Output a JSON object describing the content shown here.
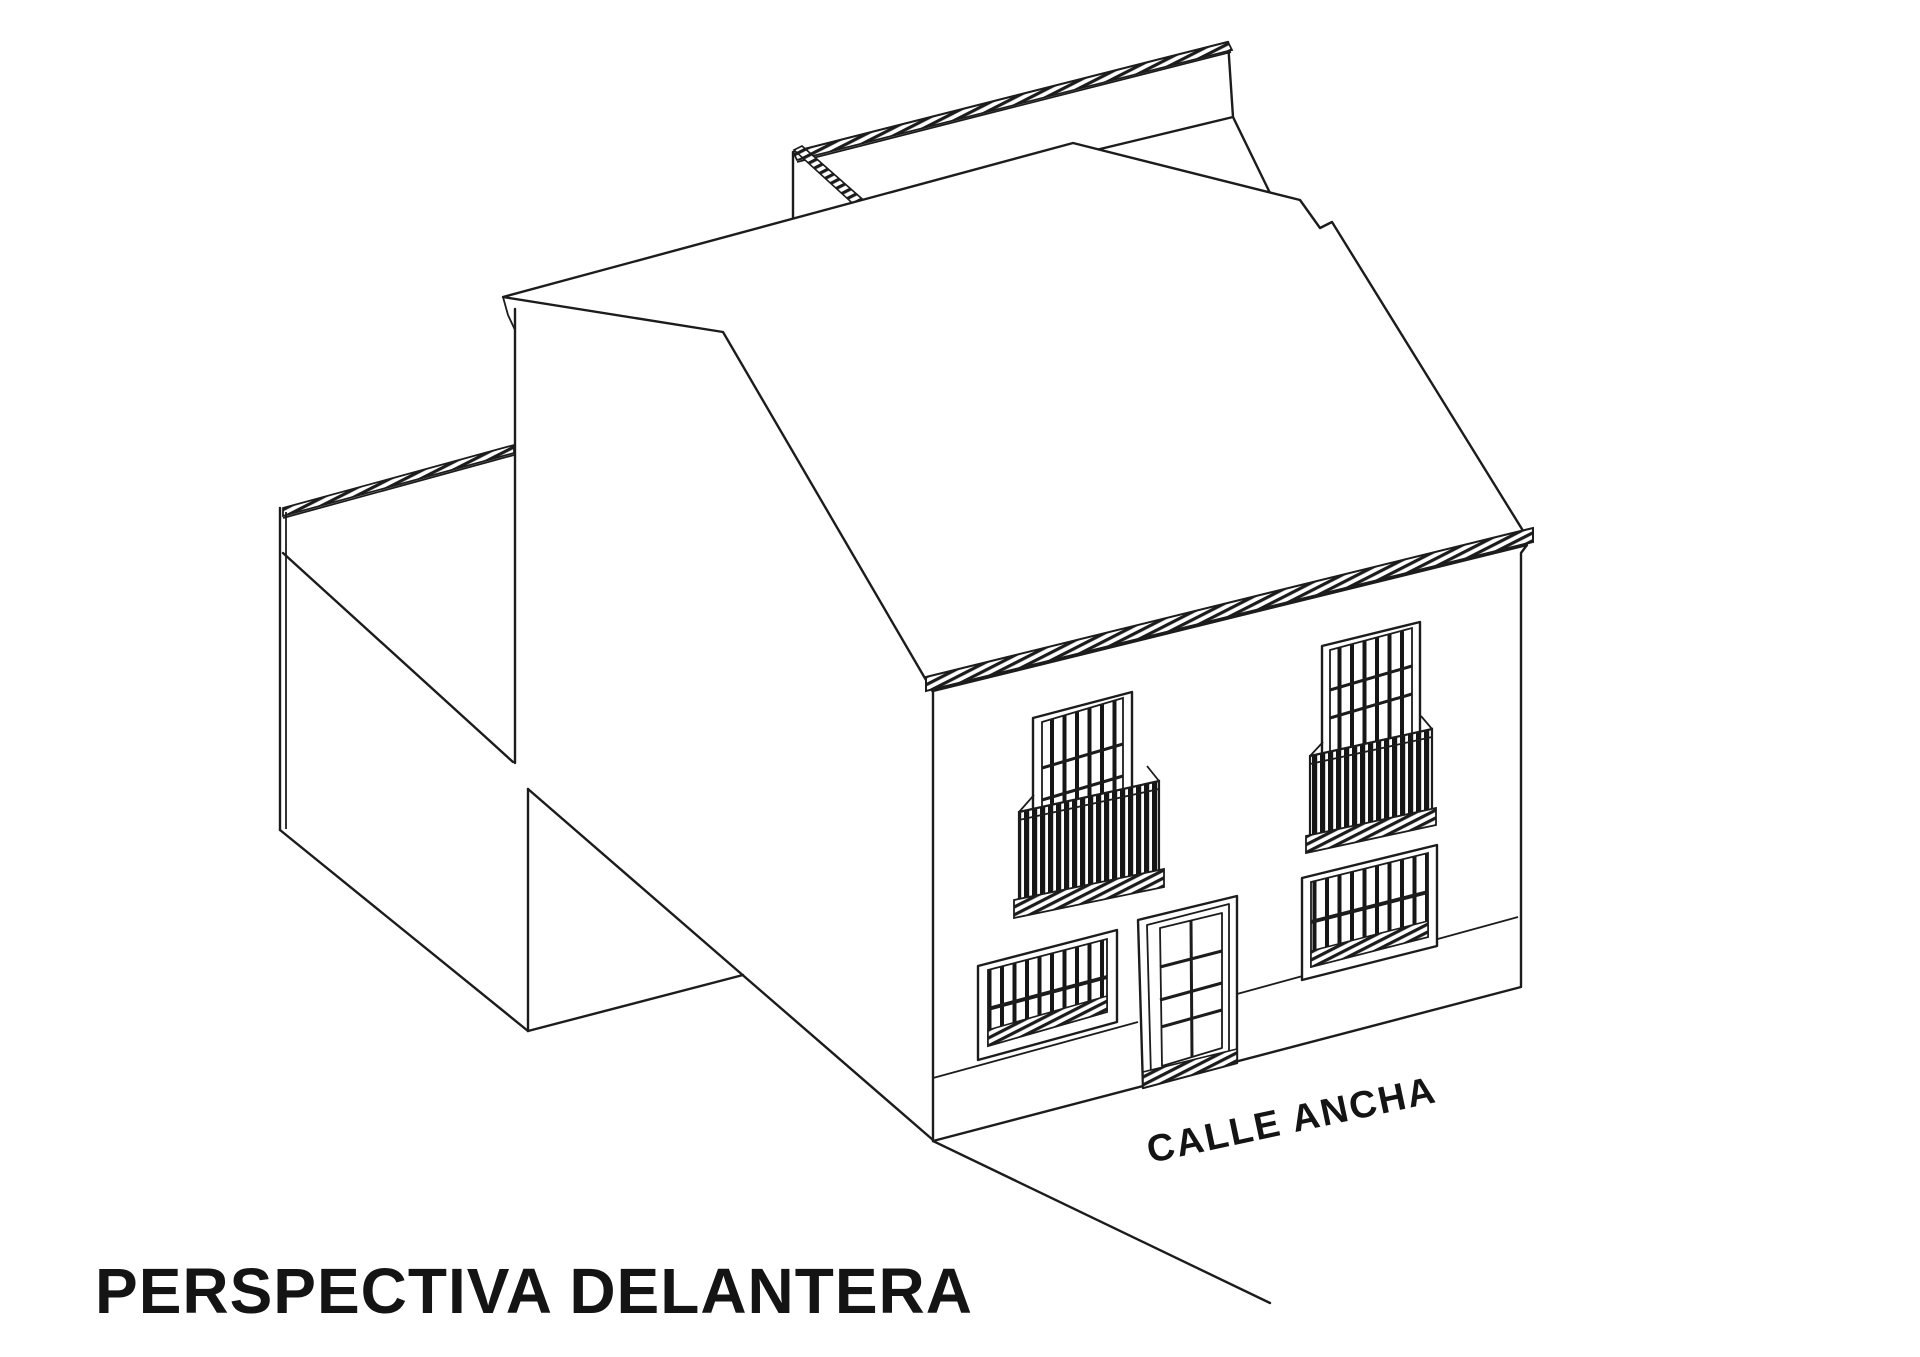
{
  "page": {
    "background_color": "#ffffff",
    "line_color": "#1c1c1c",
    "text_color": "#141414"
  },
  "drawing": {
    "title": "PERSPECTIVA DELANTERA",
    "street_label": "CALLE ANCHA",
    "type_label": "architectural perspective line drawing",
    "elements": {
      "rear_boundary_wall": "rear-boundary-wall-with-tile-coping",
      "main_roof": "pitched-roof-front-slope",
      "eave": "hatched-eave-cornice",
      "facade": "two-storey-street-facade",
      "courtyard": "side-courtyard-walls",
      "upper_windows_with_balconies": 2,
      "lower_barred_windows": 2,
      "doors": 1
    }
  }
}
